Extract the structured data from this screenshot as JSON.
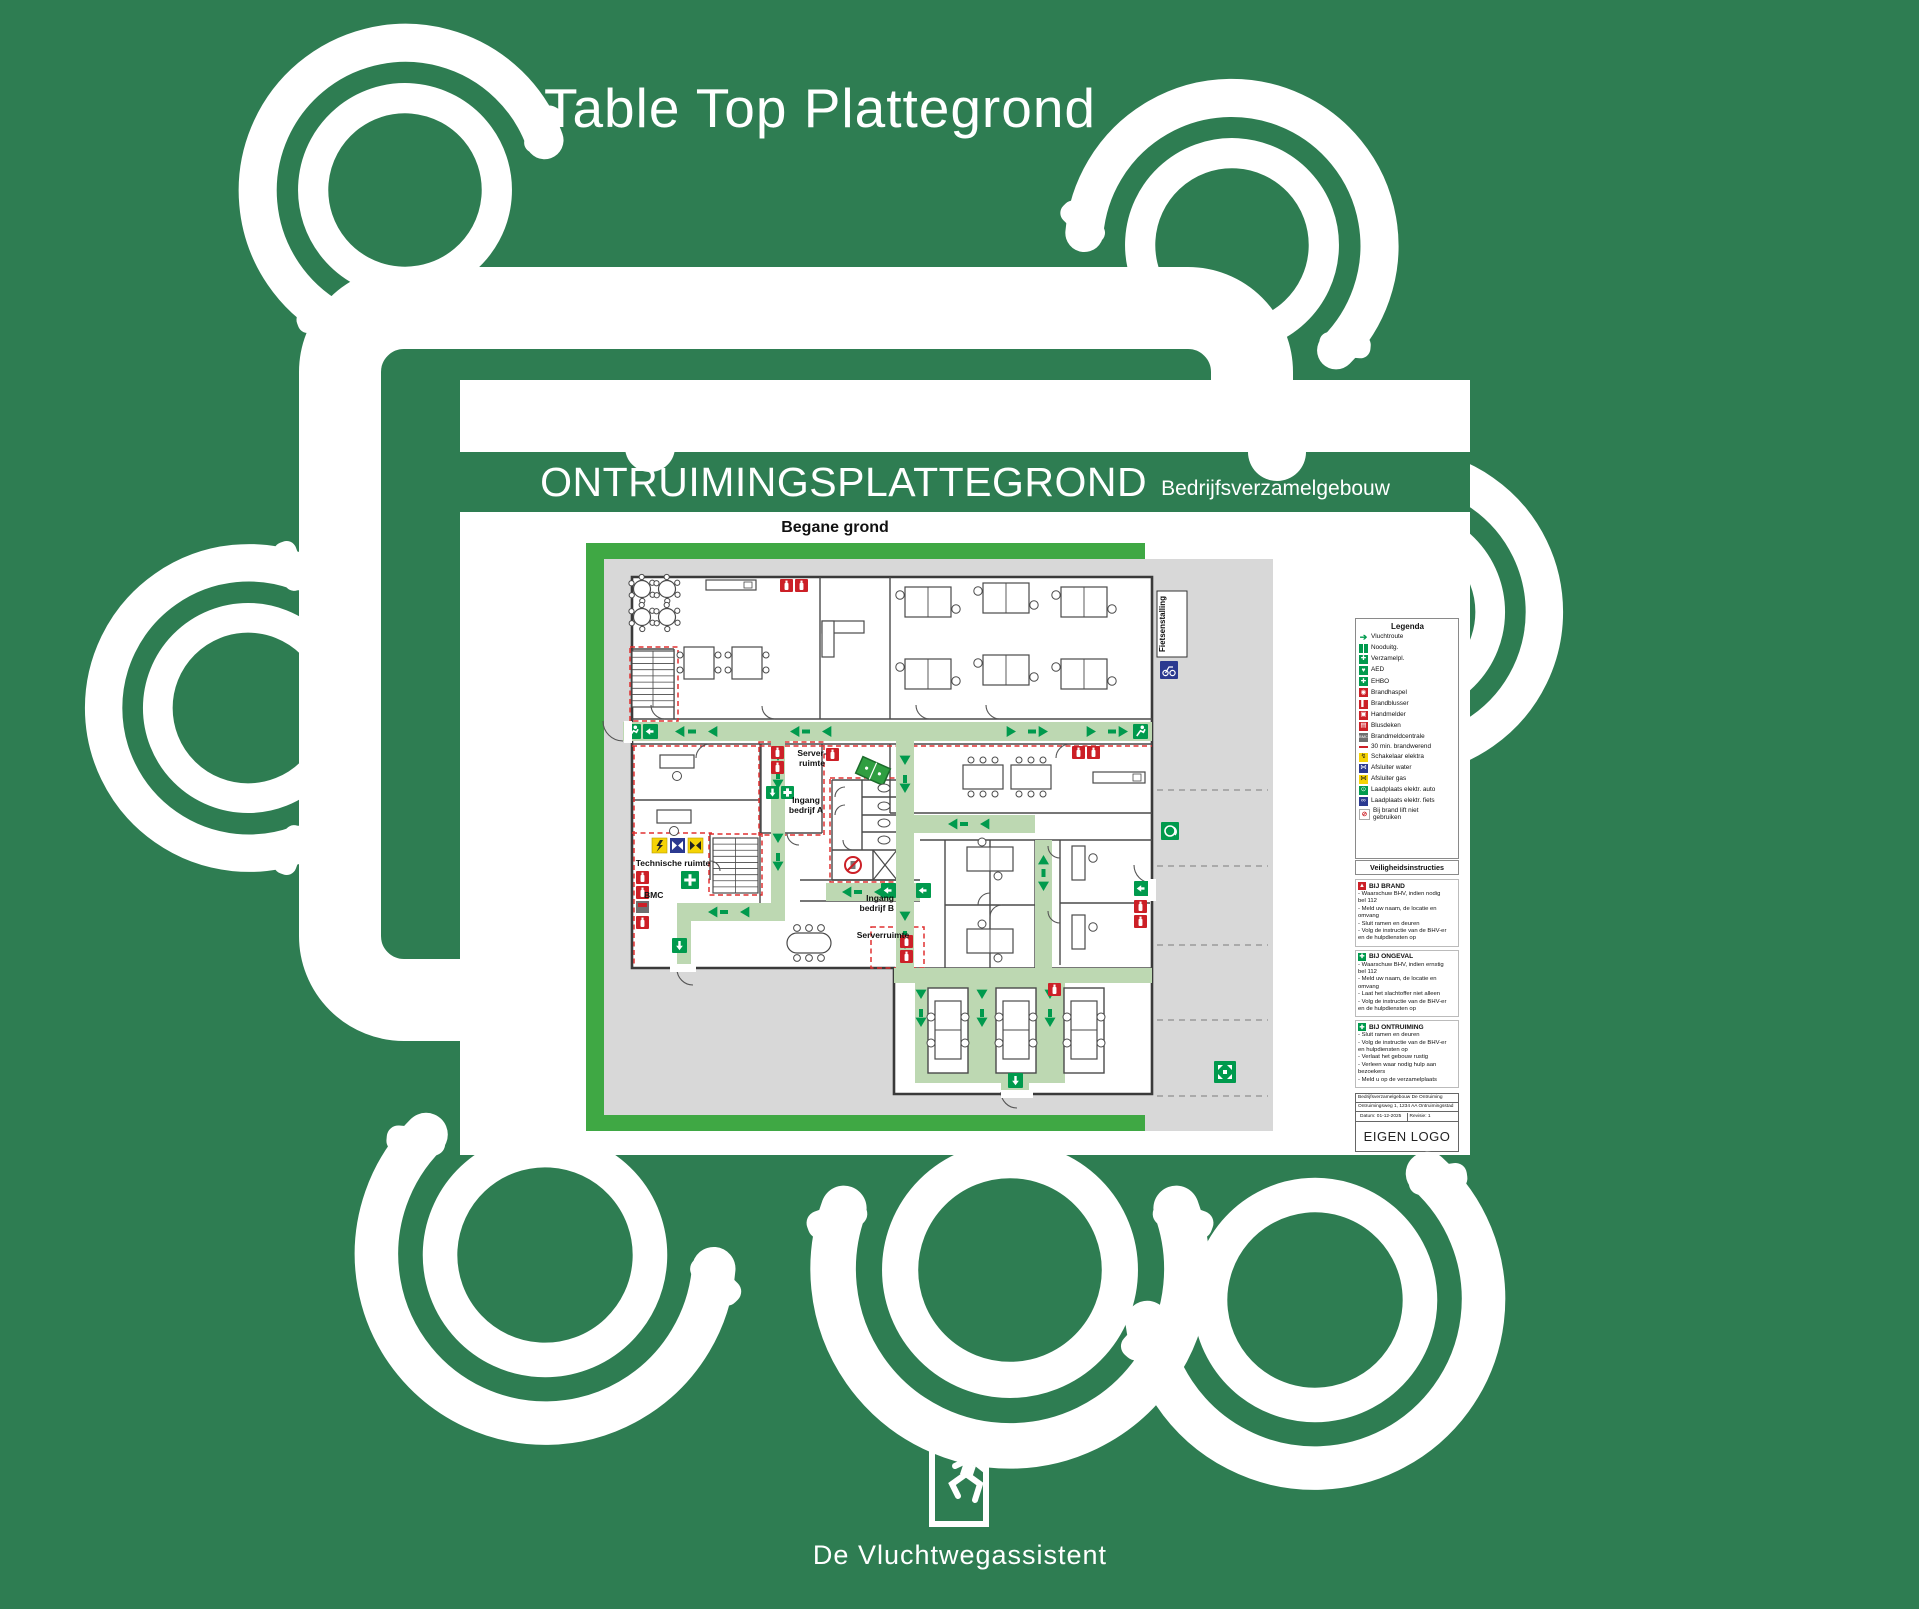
{
  "page": {
    "background_color": "#2e7d52",
    "title": "Table Top Plattegrond",
    "footer_brand": "De Vluchtwegassistent"
  },
  "poster": {
    "header": {
      "title": "ONTRUIMINGSPLATTEGROND",
      "subtitle": "Bedrijfsverzamelgebouw"
    },
    "floor_label": "Begane grond",
    "plan_labels": {
      "server_room_top": "Server-\nruimte",
      "entrance_a": "Ingang\nbedrijf A",
      "technical_room": "Technische ruimte",
      "bmc": "BMC",
      "entrance_b": "Ingang\nbedrijf B",
      "server_room_bottom": "Serverruimte",
      "bike_shed": "Fietsenstalling"
    },
    "legend": {
      "title": "Legenda",
      "items": [
        {
          "icon": "escape-route-arrow-icon",
          "label": "Vluchtroute"
        },
        {
          "icon": "emergency-exit-icon",
          "label": "Nooduitg."
        },
        {
          "icon": "assembly-point-icon",
          "label": "Verzamelpl."
        },
        {
          "icon": "aed-icon",
          "label": "AED"
        },
        {
          "icon": "first-aid-icon",
          "label": "EHBO"
        },
        {
          "icon": "fire-hose-icon",
          "label": "Brandhaspel"
        },
        {
          "icon": "fire-extinguisher-icon",
          "label": "Brandblusser"
        },
        {
          "icon": "manual-call-point-icon",
          "label": "Handmelder"
        },
        {
          "icon": "fire-blanket-icon",
          "label": "Blusdeken"
        },
        {
          "icon": "fire-alarm-panel-icon",
          "label": "Brandmeldcentrale"
        },
        {
          "icon": "fire-resistant-line-icon",
          "label": "30 min. brandwerend"
        },
        {
          "icon": "electric-switch-icon",
          "label": "Schakelaar elektra"
        },
        {
          "icon": "water-valve-icon",
          "label": "Afsluiter water"
        },
        {
          "icon": "gas-valve-icon",
          "label": "Afsluiter gas"
        },
        {
          "icon": "ev-charger-car-icon",
          "label": "Laadplaats elektr. auto"
        },
        {
          "icon": "ev-charger-bike-icon",
          "label": "Laadplaats elektr. fiets"
        },
        {
          "icon": "no-lift-icon",
          "label": "Bij brand lift niet\ngebruiken"
        }
      ]
    },
    "instructions": {
      "title": "Veiligheidsinstructies",
      "sections": [
        {
          "icon": "fire-icon",
          "title": "BIJ BRAND",
          "lines": "- Waarschuw BHV, indien nodig\n  bel 112\n- Meld uw naam, de locatie en\n  omvang\n- Sluit ramen en deuren\n- Volg de instructie van de BHV-er\n  en de hulpdiensten op"
        },
        {
          "icon": "first-aid-icon",
          "title": "BIJ ONGEVAL",
          "lines": "- Waarschuw BHV, indien ernstig\n  bel 112\n- Meld uw naam, de locatie en\n  omvang\n- Laat het slachtoffer niet alleen\n- Volg de instructie van de BHV-er\n  en de hulpdiensten op"
        },
        {
          "icon": "assembly-point-icon",
          "title": "BIJ ONTRUIMING",
          "lines": "- Sluit ramen en deuren\n- Volg de instructie van de BHV-er\n  en hulpdiensten op\n- Verlaat het gebouw rustig\n- Verleen waar nodig hulp aan\n  bezoekers\n- Meld u op de verzamelplaats"
        }
      ]
    },
    "title_block": {
      "building": "Bedrijfsverzamelgebouw De Ontruiming",
      "address": "Ontruimingsweg 1, 1234 AA Ontruimingsstad",
      "date": "Datum: 01-12-2025",
      "revision": "Revisie: 1",
      "author": "Tekenaar: De Vluchtwegassistent",
      "logo_placeholder": "EIGEN LOGO"
    }
  }
}
